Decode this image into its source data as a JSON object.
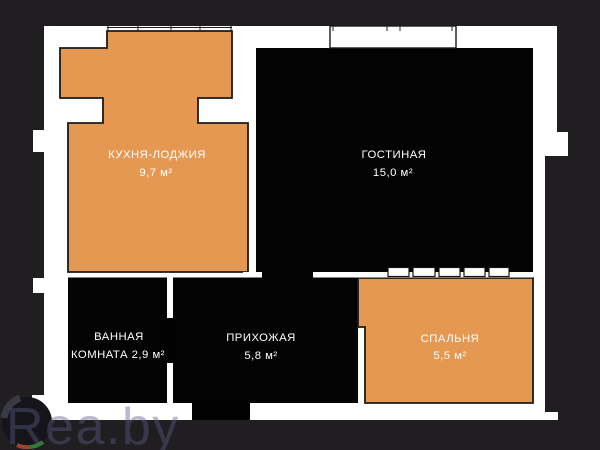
{
  "colors": {
    "background": "#211e21",
    "wall_white": "#ffffff",
    "room_dark": "#030303",
    "room_orange": "#e49852",
    "outline": "#1a1a1a",
    "label_text": "#ffffff",
    "watermark": "rgba(88,94,130,0.42)"
  },
  "rooms": [
    {
      "id": "kitchen-loggia",
      "name": "КУХНЯ-ЛОДЖИЯ",
      "area": "9,7 м²"
    },
    {
      "id": "living-room",
      "name": "ГОСТИНАЯ",
      "area": "15,0 м²"
    },
    {
      "id": "bathroom",
      "name": "ВАННАЯ КОМНАТА",
      "area": "2,9 м²",
      "label_line1": "ВАННАЯ",
      "label_line2": "КОМНАТА 2,9 м²"
    },
    {
      "id": "hallway",
      "name": "ПРИХОЖАЯ",
      "area": "5,8 м²"
    },
    {
      "id": "bedroom",
      "name": "СПАЛЬНЯ",
      "area": "5,5 м²"
    }
  ],
  "watermark": {
    "text": "Rea.by"
  }
}
